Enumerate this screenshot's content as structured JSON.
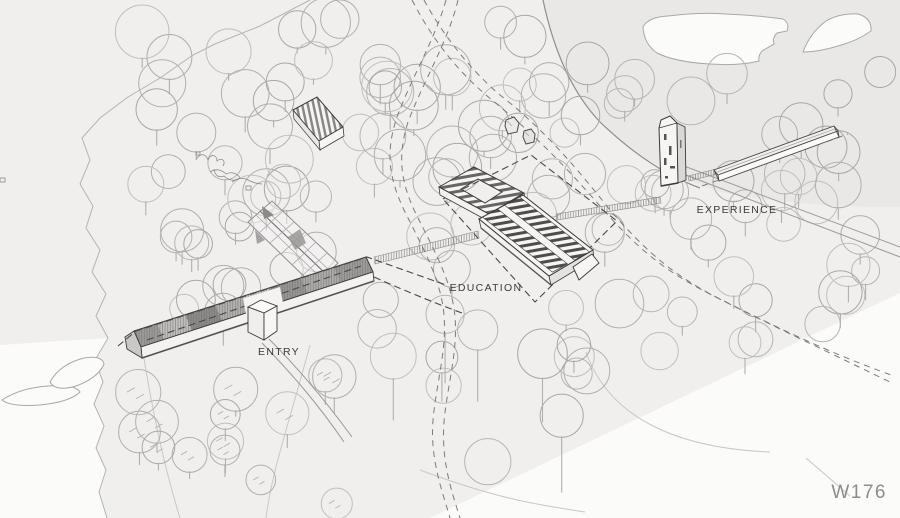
{
  "drawing": {
    "kind": "architectural-site-axonometric",
    "labels": {
      "entry": "ENTRY",
      "education": "EDUCATION",
      "experience": "EXPERIENCE"
    },
    "sheet_code": "W176",
    "colors": {
      "background": "#f0efee",
      "background_shade": "#e9e8e7",
      "water": "#fbfbfa",
      "tree_line": "#b3b2b0",
      "path_line": "#7c7b79",
      "contour_line": "#c9c8c6",
      "building_line": "#3c3b3a",
      "roof_dark": "#8a8987",
      "label_text": "#3b3a39",
      "sheet_text": "#8d8c8a"
    }
  }
}
